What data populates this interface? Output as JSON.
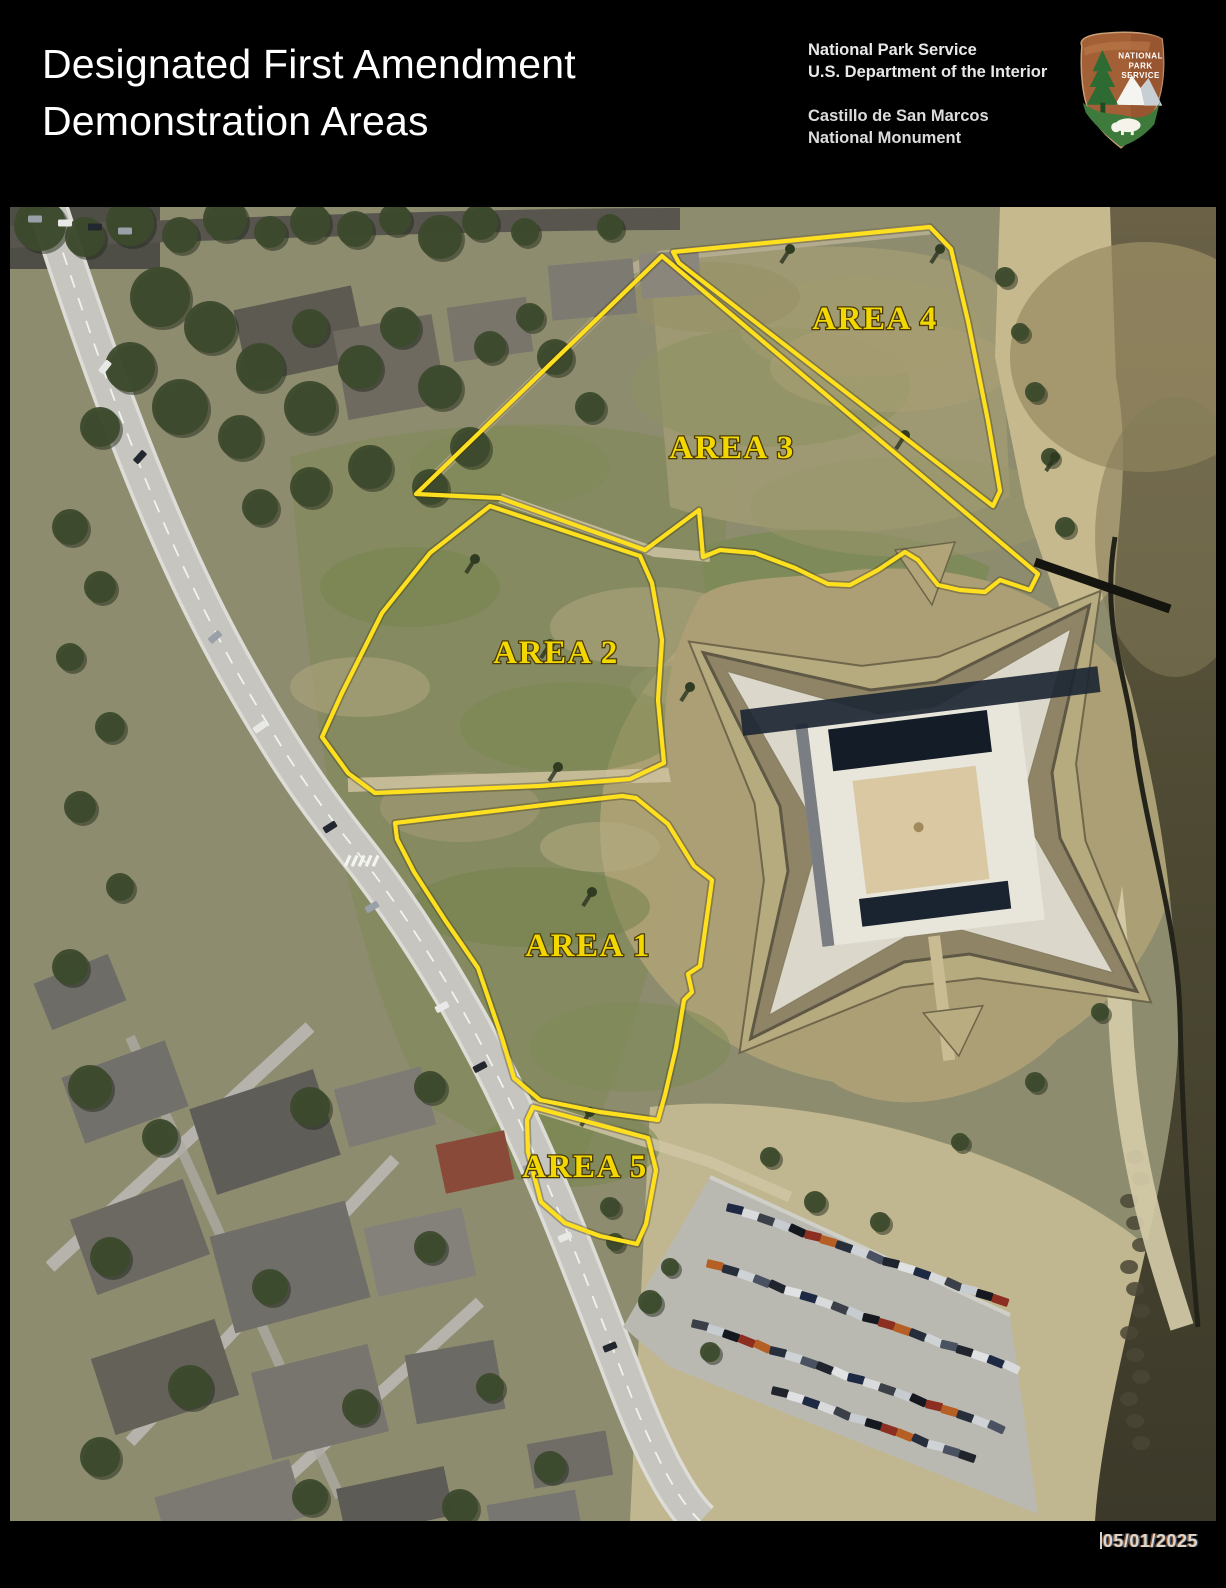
{
  "header": {
    "title_line1": "Designated First Amendment",
    "title_line2": "Demonstration Areas",
    "agency_line1": "National Park Service",
    "agency_line2": "U.S. Department of the Interior",
    "park_line1": "Castillo de San Marcos",
    "park_line2": "National Monument",
    "logo_text_line1": "NATIONAL",
    "logo_text_line2": "PARK",
    "logo_text_line3": "SERVICE"
  },
  "map": {
    "areas": [
      {
        "id": "area-1",
        "label": "AREA 1"
      },
      {
        "id": "area-2",
        "label": "AREA 2"
      },
      {
        "id": "area-3",
        "label": "AREA 3"
      },
      {
        "id": "area-4",
        "label": "AREA 4"
      },
      {
        "id": "area-5",
        "label": "AREA 5"
      }
    ],
    "outline_color": "#ffe01e",
    "label_fill": "#f2d800",
    "label_outline_color": "#4a3a05"
  },
  "footer": {
    "date": "05/01/2025"
  }
}
